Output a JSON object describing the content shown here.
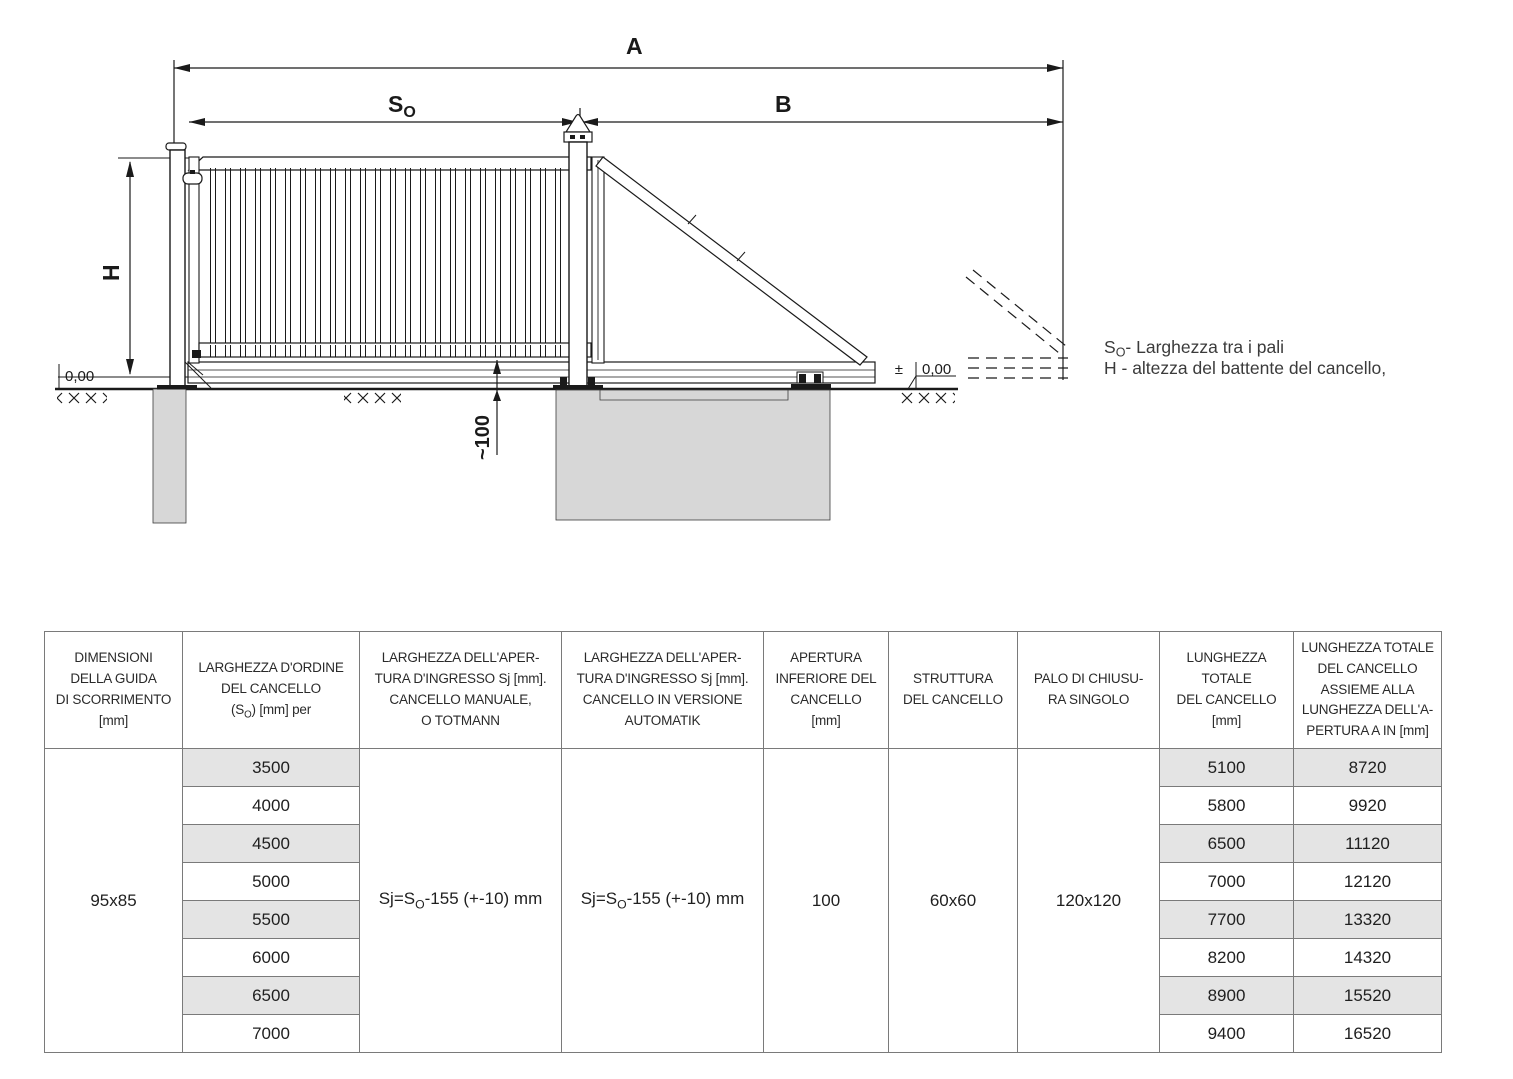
{
  "diagram": {
    "dim_a": "A",
    "dim_b": "B",
    "dim_so": {
      "pre": "S",
      "sub": "O"
    },
    "dim_h": "H",
    "dim_gap": "~100",
    "level_left": "0,00",
    "level_right_pm": "±",
    "level_right_val": "0,00",
    "legend_line1": {
      "pre": "S",
      "sub": "O",
      "post": "- Larghezza tra i pali"
    },
    "legend_line2": "H - altezza del battente del cancello,"
  },
  "table": {
    "headers": {
      "col1": "DIMENSIONI\nDELLA GUIDA\nDI SCORRIMENTO\n[mm]",
      "col2_pre": "LARGHEZZA D'ORDINE\nDEL CANCELLO\n(S",
      "col2_sub": "O",
      "col2_post": ") [mm] per",
      "col3": "LARGHEZZA DELL'APER-\nTURA D'INGRESSO Sj [mm].\nCANCELLO MANUALE,\nO TOTMANN",
      "col4": "LARGHEZZA DELL'APER-\nTURA D'INGRESSO Sj [mm].\nCANCELLO IN VERSIONE\nAUTOMATIK",
      "col5": "APERTURA\nINFERIORE DEL\nCANCELLO\n[mm]",
      "col6": "STRUTTURA\nDEL CANCELLO",
      "col7": "PALO DI CHIUSU-\nRA SINGOLO",
      "col8": "LUNGHEZZA\nTOTALE\nDEL CANCELLO\n[mm]",
      "col9": "LUNGHEZZA TOTALE\nDEL CANCELLO\nASSIEME ALLA\nLUNGHEZZA DELL'A-\nPERTURA A IN [mm]"
    },
    "merged": {
      "guide_size": "95x85",
      "manual_formula": {
        "pre": "Sj=S",
        "sub": "O",
        "post": "-155 (+-10) mm"
      },
      "auto_formula": {
        "pre": "Sj=S",
        "sub": "O",
        "post": "-155 (+-10) mm"
      },
      "apertura": "100",
      "struttura": "60x60",
      "palo": "120x120"
    },
    "rows": [
      {
        "so": "3500",
        "len": "5100",
        "total": "8720"
      },
      {
        "so": "4000",
        "len": "5800",
        "total": "9920"
      },
      {
        "so": "4500",
        "len": "6500",
        "total": "11120"
      },
      {
        "so": "5000",
        "len": "7000",
        "total": "12120"
      },
      {
        "so": "5500",
        "len": "7700",
        "total": "13320"
      },
      {
        "so": "6000",
        "len": "8200",
        "total": "14320"
      },
      {
        "so": "6500",
        "len": "8900",
        "total": "15520"
      },
      {
        "so": "7000",
        "len": "9400",
        "total": "16520"
      }
    ]
  },
  "colors": {
    "line": "#1a1a1a",
    "row_shade": "#e4e4e4",
    "table_border": "#7a7a7a",
    "foundation_fill": "#d7d7d7"
  }
}
